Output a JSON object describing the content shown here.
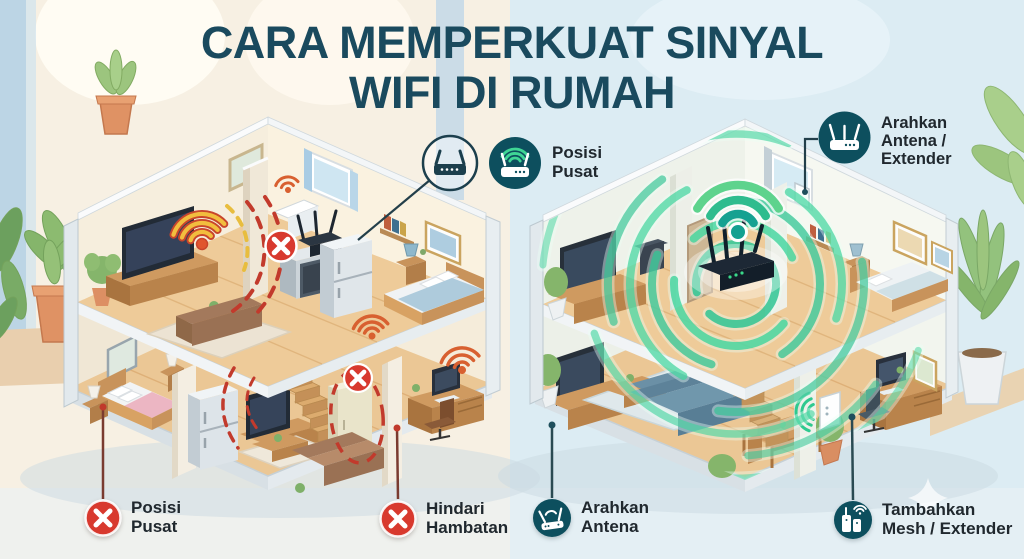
{
  "title": {
    "line1": "CARA MEMPERKUAT SINYAL",
    "line2": "WIFI DI RUMAH"
  },
  "callouts": {
    "posisi_pusat_top": {
      "label": "Posisi Pusat",
      "lines": [
        "Posisi",
        "Pusat"
      ]
    },
    "arahkan_antena_extender": {
      "label": "Arahkan Antena / Extender",
      "lines": [
        "Arahkan",
        "Antena /",
        "Extender"
      ]
    },
    "posisi_pusat_bottom": {
      "label": "Posisi Pusat",
      "lines": [
        "Posisi",
        "Pusat"
      ]
    },
    "hindari_hambatan": {
      "label": "Hindari Hambatan",
      "lines": [
        "Hindari",
        "Hambatan"
      ]
    },
    "arahkan_antena": {
      "label": "Arahkan Antena",
      "lines": [
        "Arahkan",
        "Antena"
      ]
    },
    "tambahkan_mesh_extender": {
      "label": "Tambahkan Mesh / Extender",
      "lines": [
        "Tambahkan",
        "Mesh / Extender"
      ]
    }
  },
  "colors": {
    "title_text": "#1a4a5e",
    "label_text": "#20282e",
    "bad_marker_red": "#d8392e",
    "tip_circle_teal": "#0d4f5e",
    "strong_signal_green": "#2fc795",
    "weak_signal_yellow": "#f2bd3e",
    "weak_signal_red": "#c8452c"
  }
}
